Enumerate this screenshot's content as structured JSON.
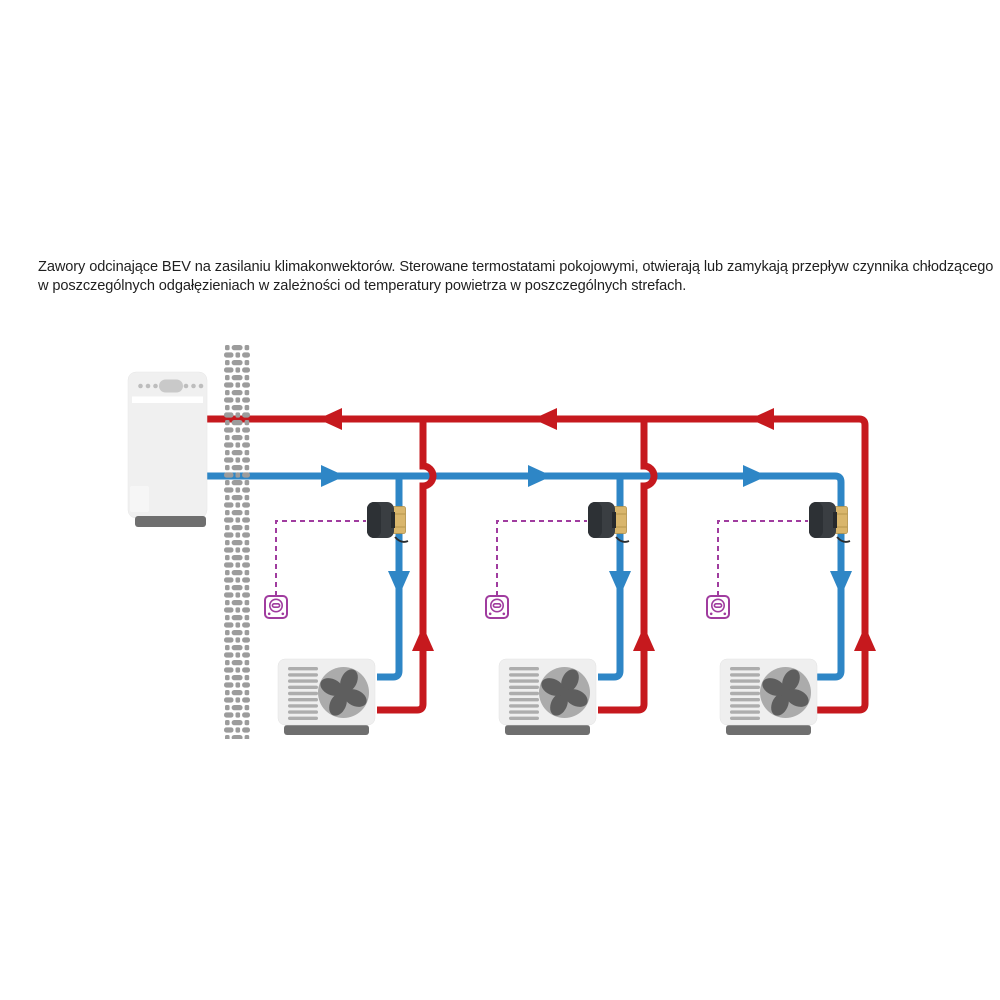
{
  "caption": {
    "line1": "Zawory odcinające BEV na zasilaniu klimakonwektorów. Sterowane termostatami pokojowymi, otwierają lub zamykają przepływ czynnika chłodzącego",
    "line2": "w poszczególnych odgałęzieniach w zależności od temperatury powietrza w poszczególnych strefach."
  },
  "colors": {
    "pipe-supply": "#2E86C6",
    "pipe-return": "#C6191E",
    "control": "#A03C9F",
    "wall": "#9C9C9C",
    "unit-body": "#F0F0F0",
    "unit-base": "#6F6F6F",
    "detail-gray": "#C3C3C3",
    "fan-housing": "#ABABAB",
    "fan-blade": "#5E5E5E",
    "slat": "#ADADAD",
    "actuator": "#3A3E42",
    "actuator-dark": "#2D3135",
    "brass": "#D9B66C",
    "brass-edge": "#B08E45",
    "text": "#1F1F1F"
  }
}
